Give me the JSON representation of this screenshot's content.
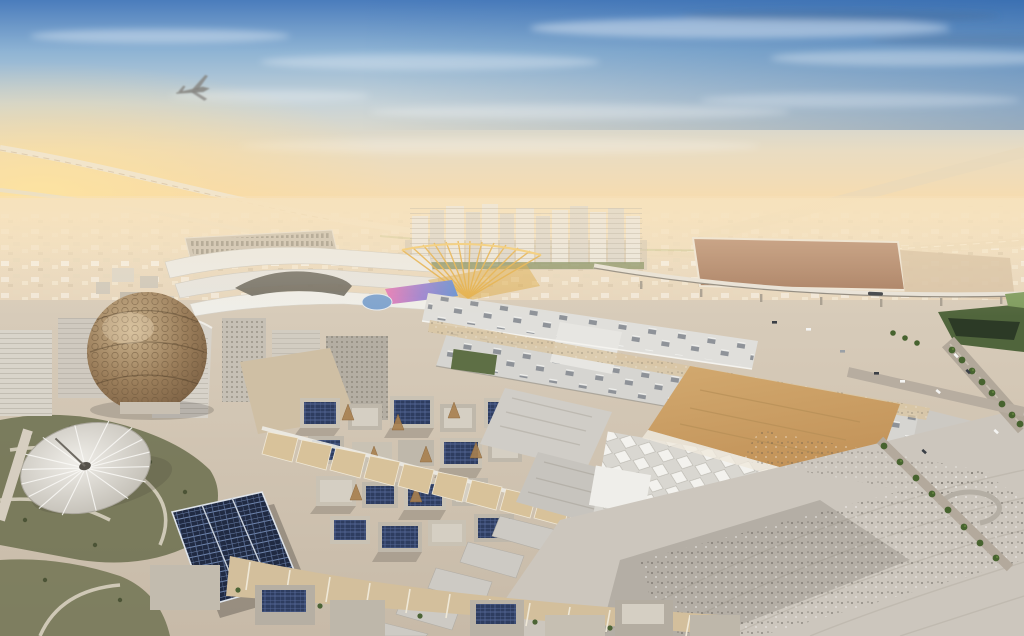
{
  "image": {
    "alt": "Aerial rendering of a vast expo city in the desert at sunset: a bronze lattice dome and a white ribbed canopy on the left, long white exhibition halls in the center, low-rise buildings with rooftop solar panels, a golden entry portal, palm-lined boulevards, crowded plazas, and an airplane flying in a blue-to-orange sky."
  },
  "colors": {
    "sky_top": "#4a7cbc",
    "sky_upper": "#8fb4d4",
    "sky_mid": "#c7d3d8",
    "sky_warm": "#e9dcc2",
    "sky_horizon": "#f6dcb0",
    "sky_low": "#f8e0ba",
    "sun_glow": "#fde3a0",
    "desert_far": "#f3e3c6",
    "desert_near": "#e2d1ba",
    "ground_top": "#d8ccba",
    "ground_bottom": "#c7baa8",
    "hall_roof": "#d6d5d1",
    "hall_roof_upper": "#e0dfdb",
    "vent_gray": "#868b92",
    "canopy_tan": "#d8c29a",
    "wheat_top": "#d2a96f",
    "wheat_bottom": "#c19157",
    "solar_dark": "#2e3d60",
    "solar_big": "#202a42",
    "dome_hi": "#cbb38d",
    "dome_mid": "#9a7d5a",
    "dome_low": "#7c6144",
    "terra_hi": "#f0eee9",
    "terra_edge": "#c2beb5",
    "vegetation": "#6b6f4e",
    "palm_green": "#47632f",
    "park_green": "#50653c",
    "pond_dark": "#2c3a26",
    "dirt_lot_hi": "#b98f74",
    "dirt_lot_lo": "#a97f63",
    "road": "#b2a89a",
    "plaza": "#ccc6bd",
    "plane_gray": "#84827e",
    "gold_portal": "#e5b14c",
    "gold_edge": "#f3cc74",
    "led_pink": "#e878b5",
    "led_violet": "#9b7fd0",
    "led_blue": "#5f8fd8",
    "tower_light": "#ece8e0",
    "tower_dark": "#ddd8cf",
    "tent_bg": "#d9d7d1",
    "tent_face": "#f3f2ee"
  }
}
